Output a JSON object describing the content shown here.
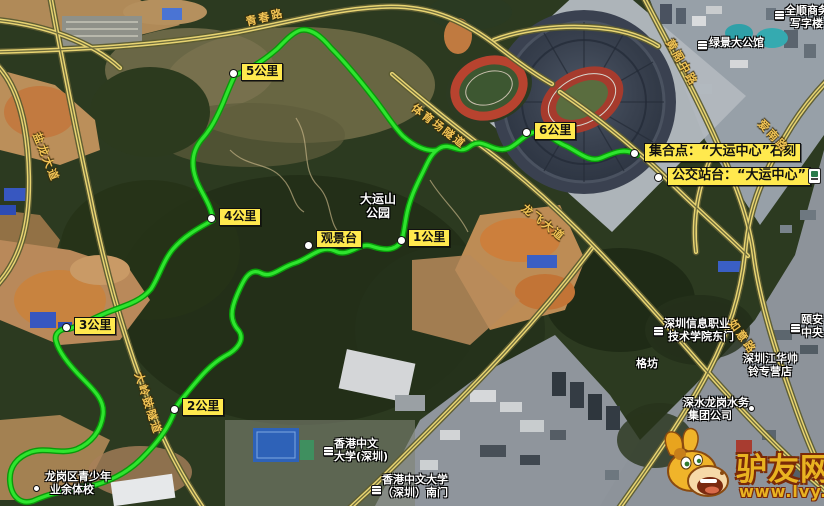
{
  "colors": {
    "route_green": "#2ee52e",
    "marker_yellow": "#ffe94e",
    "road_yellow": "#e8d472",
    "road_label_gold": "#f2c455",
    "watermark_gold": "#e9b321"
  },
  "route": {
    "km_markers": [
      "1公里",
      "2公里",
      "3公里",
      "4公里",
      "5公里",
      "6公里"
    ],
    "viewpoint": "观景台",
    "meeting_point": "集合点：“大运中心”石刻",
    "bus_stop": "公交站台：“大运中心”"
  },
  "park": {
    "line1": "大运山",
    "line2": "公园"
  },
  "roads": {
    "qingchun": "青春路",
    "yanlong": "盐龙大道",
    "tiyuchang": "体育场隧道",
    "huangge": "黄阁中路",
    "ainan": "爱南路",
    "longfei": "龙飞大道",
    "ruyi": "如意路",
    "daling": "大岭鼓隧道"
  },
  "pois": {
    "quanshun": {
      "line1": "全顺商务",
      "line2": "写字楼"
    },
    "lvjing": {
      "line1": "绿景大公馆"
    },
    "yian": {
      "line1": "颐安",
      "line2": "中央"
    },
    "sziit": {
      "line1": "深圳信息职业",
      "line2": "技术学院东门"
    },
    "gefang": {
      "line1": "格坊"
    },
    "jianghua": {
      "line1": "深圳江华帅",
      "line2": "铃专营店"
    },
    "shenshui": {
      "line1": "深水龙岗水务",
      "line2": "集团公司"
    },
    "cuhk": {
      "line1": "香港中文",
      "line2": "大学(深圳)"
    },
    "cuhk_gate": {
      "line1": "香港中文大学",
      "line2": "（深圳）南门"
    },
    "sports_school": {
      "line1": "龙岗区青少年",
      "line2": "业余体校"
    }
  },
  "watermark": {
    "name": "驴友网",
    "url": "www.lvy.cn"
  }
}
